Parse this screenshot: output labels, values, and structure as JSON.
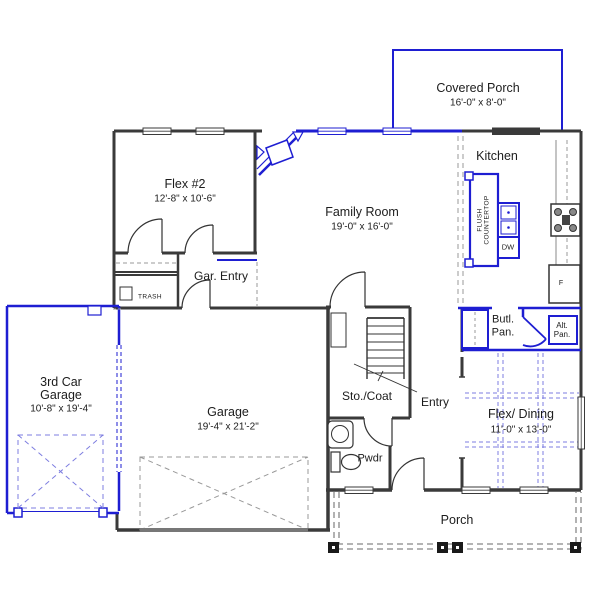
{
  "colors": {
    "wall": "#3a3a3a",
    "option_blue": "#1e1ed2",
    "dash_gray": "#999999",
    "dash_blue": "#7d7de0"
  },
  "rooms": {
    "covered_porch": {
      "label": "Covered Porch",
      "dims": "16'-0\" x 8'-0\""
    },
    "kitchen": {
      "label": "Kitchen"
    },
    "family_room": {
      "label": "Family Room",
      "dims": "19'-0\" x 16'-0\""
    },
    "flex2": {
      "label": "Flex #2",
      "dims": "12'-8\" x 10'-6\""
    },
    "gar_entry": {
      "label": "Gar. Entry"
    },
    "trash_closet": {
      "label": "TRASH"
    },
    "third_car_garage": {
      "label_line1": "3rd Car",
      "label_line2": "Garage",
      "dims": "10'-8\" x 19'-4\""
    },
    "garage": {
      "label": "Garage",
      "dims": "19'-4\" x 21'-2\""
    },
    "sto_coat": {
      "label": "Sto./Coat"
    },
    "entry": {
      "label": "Entry"
    },
    "pwdr": {
      "label": "Pwdr"
    },
    "butlers_pantry": {
      "label_line1": "Butl.",
      "label_line2": "Pan."
    },
    "alt_pantry": {
      "label_line1": "Alt.",
      "label_line2": "Pan."
    },
    "flex_dining": {
      "label": "Flex/ Dining",
      "dims": "11'-0\" x 13'-0\""
    },
    "porch": {
      "label": "Porch"
    }
  },
  "fixtures": {
    "dishwasher": "DW",
    "refrigerator": "F",
    "island_note_line1": "FLUSH",
    "island_note_line2": "COUNTERTOP"
  }
}
